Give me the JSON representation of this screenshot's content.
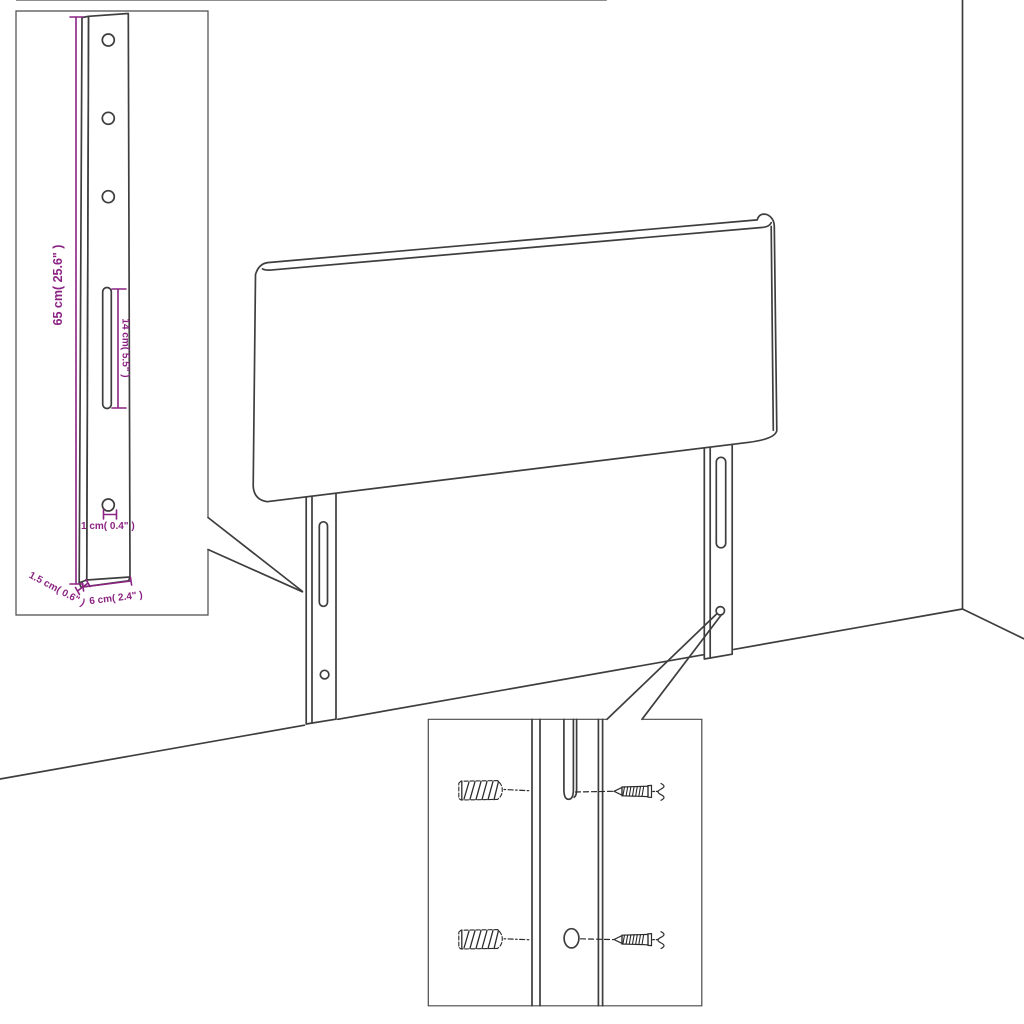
{
  "detail_bracket": {
    "height_label": "65 cm( 25.6\" )",
    "slot_label": "14 cm( 5.5\" )",
    "hole_label": "1 cm( 0.4\" )",
    "thickness_label": "1.5 cm( 0.6\" )",
    "width_label": "6 cm( 2.4\" )"
  },
  "colors": {
    "line": "#3e3e3e",
    "dimension": "#8B2383",
    "sketch": "#2b2b2b",
    "background": "#ffffff"
  }
}
